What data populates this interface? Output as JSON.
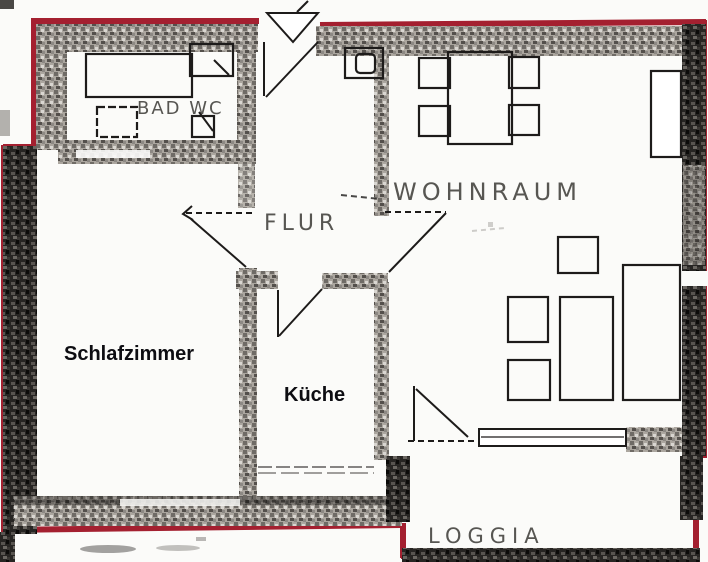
{
  "colors": {
    "outline_red": "#a42030",
    "ink": "#1d1b1a",
    "paper": "#fbfbf9",
    "scan_text": "#3a3835",
    "digital_text": "#0d0d12"
  },
  "rooms": {
    "bad_wc": {
      "label": "BAD WC"
    },
    "wohnraum": {
      "label": "WOHNRAUM"
    },
    "flur": {
      "label": "FLUR"
    },
    "schlafzimmer": {
      "label": "Schlafzimmer"
    },
    "kueche": {
      "label": "Küche"
    },
    "loggia": {
      "label": "LOGGIA"
    }
  }
}
